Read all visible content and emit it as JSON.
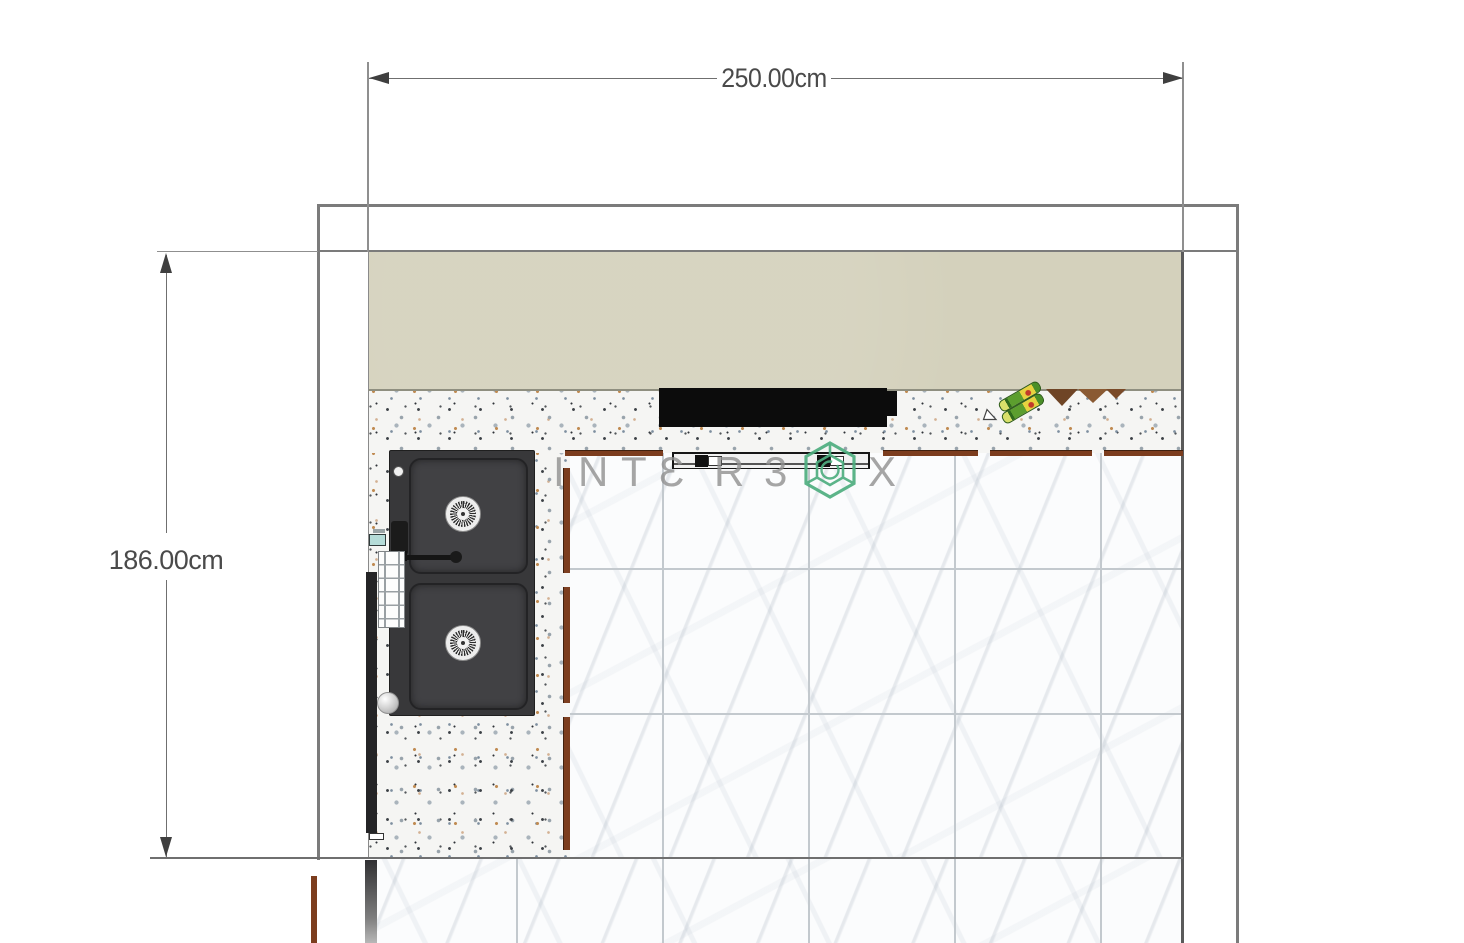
{
  "plan": {
    "title": "Kitchen floor plan top view",
    "dimensions": {
      "width_label": "250.00cm",
      "height_label": "186.00cm"
    },
    "watermark": {
      "brand": "INTERBOX",
      "letters": [
        "I",
        "N",
        "T",
        "Ɛ",
        "R",
        "3",
        "X"
      ],
      "logo": "hexagon-cube-logo",
      "logo_color": "#4fae80",
      "text_color": "#909090"
    },
    "colors": {
      "upper_cabinet_beige": "#d4d1bc",
      "terrazzo_counter": "#f5f5f3",
      "marble_floor": "#fbfcfd",
      "tile_grout": "#c3c9ce",
      "cabinet_edge_brown": "#7c3d1e",
      "wall_line_gray": "#7b7b7b",
      "dimension_gray": "#4a4a4a",
      "sink_black": "#38383a",
      "hood_black": "#0c0c0c",
      "bottle_green": "#5c9e2e"
    },
    "objects": [
      "range-hood",
      "handle-bar",
      "double-bowl-sink",
      "sink-drain",
      "faucet",
      "drying-rack",
      "soap-dispenser",
      "decor-bottles",
      "shelf-zigzag",
      "marble-floor-tiles",
      "terrazzo-countertop",
      "upper-cabinets",
      "white-sphere-decor"
    ]
  }
}
